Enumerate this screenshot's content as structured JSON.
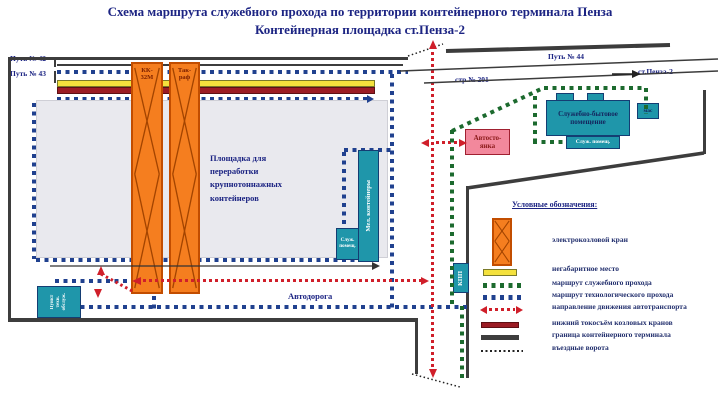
{
  "title": {
    "line1": "Схема маршрута служебного прохода по территории контейнерного терминала Пенза",
    "line2": "Контейнерная площадка ст.Пенза-2"
  },
  "tracks": {
    "path42": "Путь № 42",
    "path43": "Путь № 43",
    "path44": "Путь № 44",
    "building201": "стр.№ 201",
    "station": "ст.Пенза-2"
  },
  "cranes": {
    "crane1": "КК-\n32М",
    "crane2": "Так-\nраф"
  },
  "areas": {
    "yard": "Площадка для\nпереработки\nкрупнотоннажных\nконтейнеров",
    "road": "Автодорога",
    "parking": "Автосто-\nянка",
    "service_building": "Служебно-бытовое\nпомещение",
    "service_annex": "Служ. помещ.",
    "utility": "мас",
    "containers_small": "Мел. контейнеры",
    "checkpoint": "КПП",
    "duty_point": "Пункт\nтехн.\nобслуж."
  },
  "legend": {
    "header": "Условные обозначения:",
    "items": [
      {
        "key": "crane",
        "label": "электрокозловой кран"
      },
      {
        "key": "oversize",
        "label": "негабаритное место"
      },
      {
        "key": "service-route",
        "label": "маршрут служебного прохода"
      },
      {
        "key": "tech-route",
        "label": "маршрут технологического  прохода"
      },
      {
        "key": "traffic",
        "label": "направление движения автотранспорта"
      },
      {
        "key": "current-rail",
        "label": "нижний токосъём козловых кранов"
      },
      {
        "key": "boundary",
        "label": "граница контейнерного терминала"
      },
      {
        "key": "gates",
        "label": "въездные ворота"
      }
    ]
  },
  "colors": {
    "title_navy": "#1c2483",
    "teal_building": "#1f96aa",
    "crane_orange": "#f57e1f",
    "oversize_yellow": "#f4e13d",
    "current_rail_darkred": "#9b1c24",
    "traffic_red": "#d01f2a",
    "service_route_green": "#1c6a2e",
    "tech_route_blue": "#20418f",
    "boundary_gray": "#3d3d3d",
    "parking_pink": "#f2889c"
  }
}
